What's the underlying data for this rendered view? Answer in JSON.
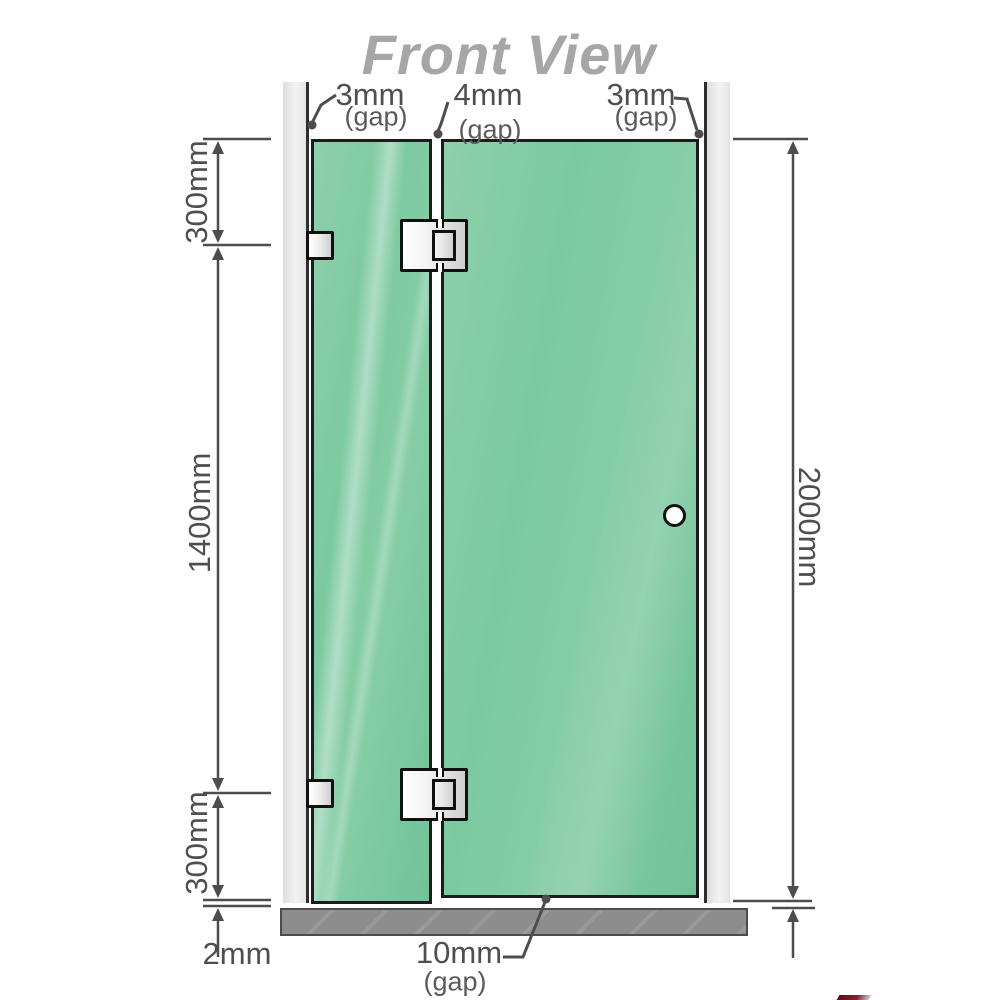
{
  "title": "Front View",
  "colors": {
    "glass_green": "#7cc9a0",
    "glass_highlight": "#a8dcc0",
    "wall_gray": "#e8e8e8",
    "base_gray": "#8d8d8d",
    "line_gray": "#4d4d4d",
    "title_gray": "#a6a6a6",
    "hardware_border": "#101010"
  },
  "view": {
    "type": "shower-screen-front-elevation",
    "panels": [
      {
        "name": "fixed-panel",
        "height_label_segments": [
          "300mm",
          "1400mm",
          "300mm"
        ]
      },
      {
        "name": "door-panel",
        "height_label": "2000mm"
      }
    ]
  },
  "labels": {
    "top_gaps": [
      {
        "value": "3mm",
        "qualifier": "(gap)"
      },
      {
        "value": "4mm",
        "qualifier": "(gap)"
      },
      {
        "value": "3mm",
        "qualifier": "(gap)"
      }
    ],
    "left_dims": {
      "top": "300mm",
      "middle": "1400mm",
      "bottom": "300mm",
      "floor_gap": "2mm"
    },
    "right_dim": "2000mm",
    "bottom_gap": {
      "value": "10mm",
      "qualifier": "(gap)"
    }
  }
}
